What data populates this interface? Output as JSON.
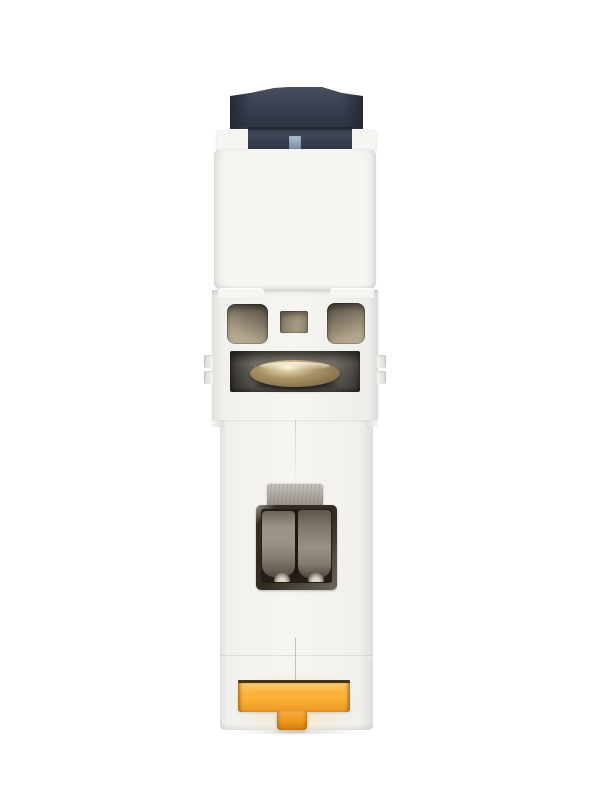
{
  "meta": {
    "type": "product-photo",
    "description": "Side profile product photo of a white single-module DIN-rail miniature circuit breaker: dark navy toggle handle with a steel-blue indicator window at the top, white plastic housing with three vent openings, a brass terminal screw behind a slot, a stamped-metal cable clamp cage in the lower half, and a yellow DIN-rail mounting clip at the bottom."
  },
  "subject": {
    "device": "miniature circuit breaker, side view",
    "orientation": "vertical; toggle at top, DIN-rail clip at bottom",
    "parts": [
      {
        "name": "toggle-handle",
        "appearance": "dark navy plastic, winged top"
      },
      {
        "name": "toggle-indicator-window",
        "appearance": "small steel-blue square"
      },
      {
        "name": "face-plate",
        "appearance": "blank white plastic panel"
      },
      {
        "name": "vent-openings",
        "appearance": "two rounded side slots and one small center slot, tan interior"
      },
      {
        "name": "terminal-screw",
        "appearance": "polished brass dome in dark recess"
      },
      {
        "name": "terminal-metal-tab",
        "appearance": "scratched gray steel tab"
      },
      {
        "name": "cable-clamp",
        "appearance": "square cage with two taupe metal jaws"
      },
      {
        "name": "din-rail-clip",
        "appearance": "yellow T-shaped slider"
      }
    ]
  },
  "colors": {
    "bg": "#ffffff",
    "body": "#f6f5f2",
    "body-edge": "#ddd9d3",
    "toggle": "#343b4b",
    "indicator": "#8ba3ba",
    "vent-tan": "#b0a28a",
    "window-metal": "#827c73",
    "brass": "#ab9366",
    "tab-metal": "#aba49a",
    "clamp-frame": "#332c23",
    "clamp-dark": "#241e16",
    "clamp-metal": "#8d8476",
    "clip-yellow": "#fbb034",
    "clip-orange": "#f09a1d",
    "clip-edge": "#46330f"
  }
}
